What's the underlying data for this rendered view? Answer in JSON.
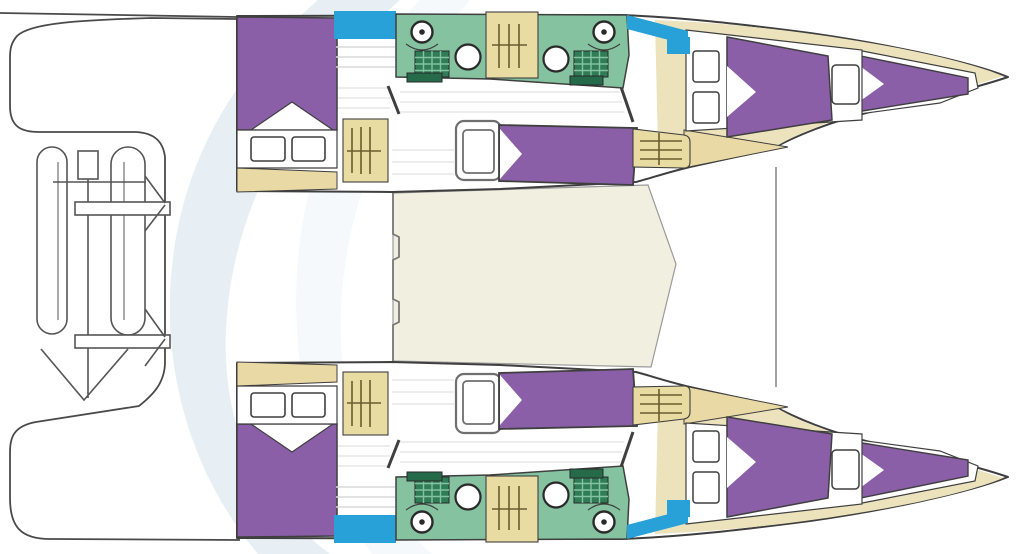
{
  "diagram": {
    "type": "boat-floor-plan",
    "subject": "sailing catamaran interior layout, top view",
    "orientation": "bows-right",
    "hull_count": 2,
    "hulls": [
      {
        "name": "port-hull",
        "spaces": [
          "aft-double-berth-cabin",
          "companionway-steps",
          "head-with-toilet-sink-shower",
          "shower-room-with-toilet-sink",
          "mid-double-berth",
          "forward-double-berth-cabin",
          "forepeak-berth"
        ]
      },
      {
        "name": "starboard-hull",
        "spaces": [
          "aft-double-berth-cabin",
          "companionway-steps",
          "head-with-toilet-sink-shower",
          "shower-room-with-toilet-sink",
          "mid-double-berth",
          "forward-double-berth-cabin",
          "forepeak-berth"
        ]
      }
    ],
    "shared_spaces": [
      "aft-cockpit",
      "saloon-bridgedeck",
      "foredeck",
      "stern-platform-with-davits-and-dinghy",
      "forward-crossbeam"
    ],
    "berth_total": 8,
    "toilet_total": 4,
    "sink_total": 4
  },
  "colors": {
    "background": "#ffffff",
    "outline": "#3f3f3f",
    "berth_purple": "#8a5fa8",
    "head_green": "#84c2a0",
    "grate_green": "#2f7c57",
    "cabinet_green": "#256b4a",
    "steps_tan": "#e9dca2",
    "steps_rung": "#6a5d2e",
    "cabin_floor_tan": "#e9d9a4",
    "saloon_cream": "#f1efdf",
    "sidedeck_cream": "#ece3bd",
    "window_blue": "#28a0d8",
    "floor_stripe": "#e2e2e2",
    "wall_gray": "#8c8c8c",
    "watermark_blue": "#dfeaf0",
    "fixture_white": "#ffffff"
  }
}
